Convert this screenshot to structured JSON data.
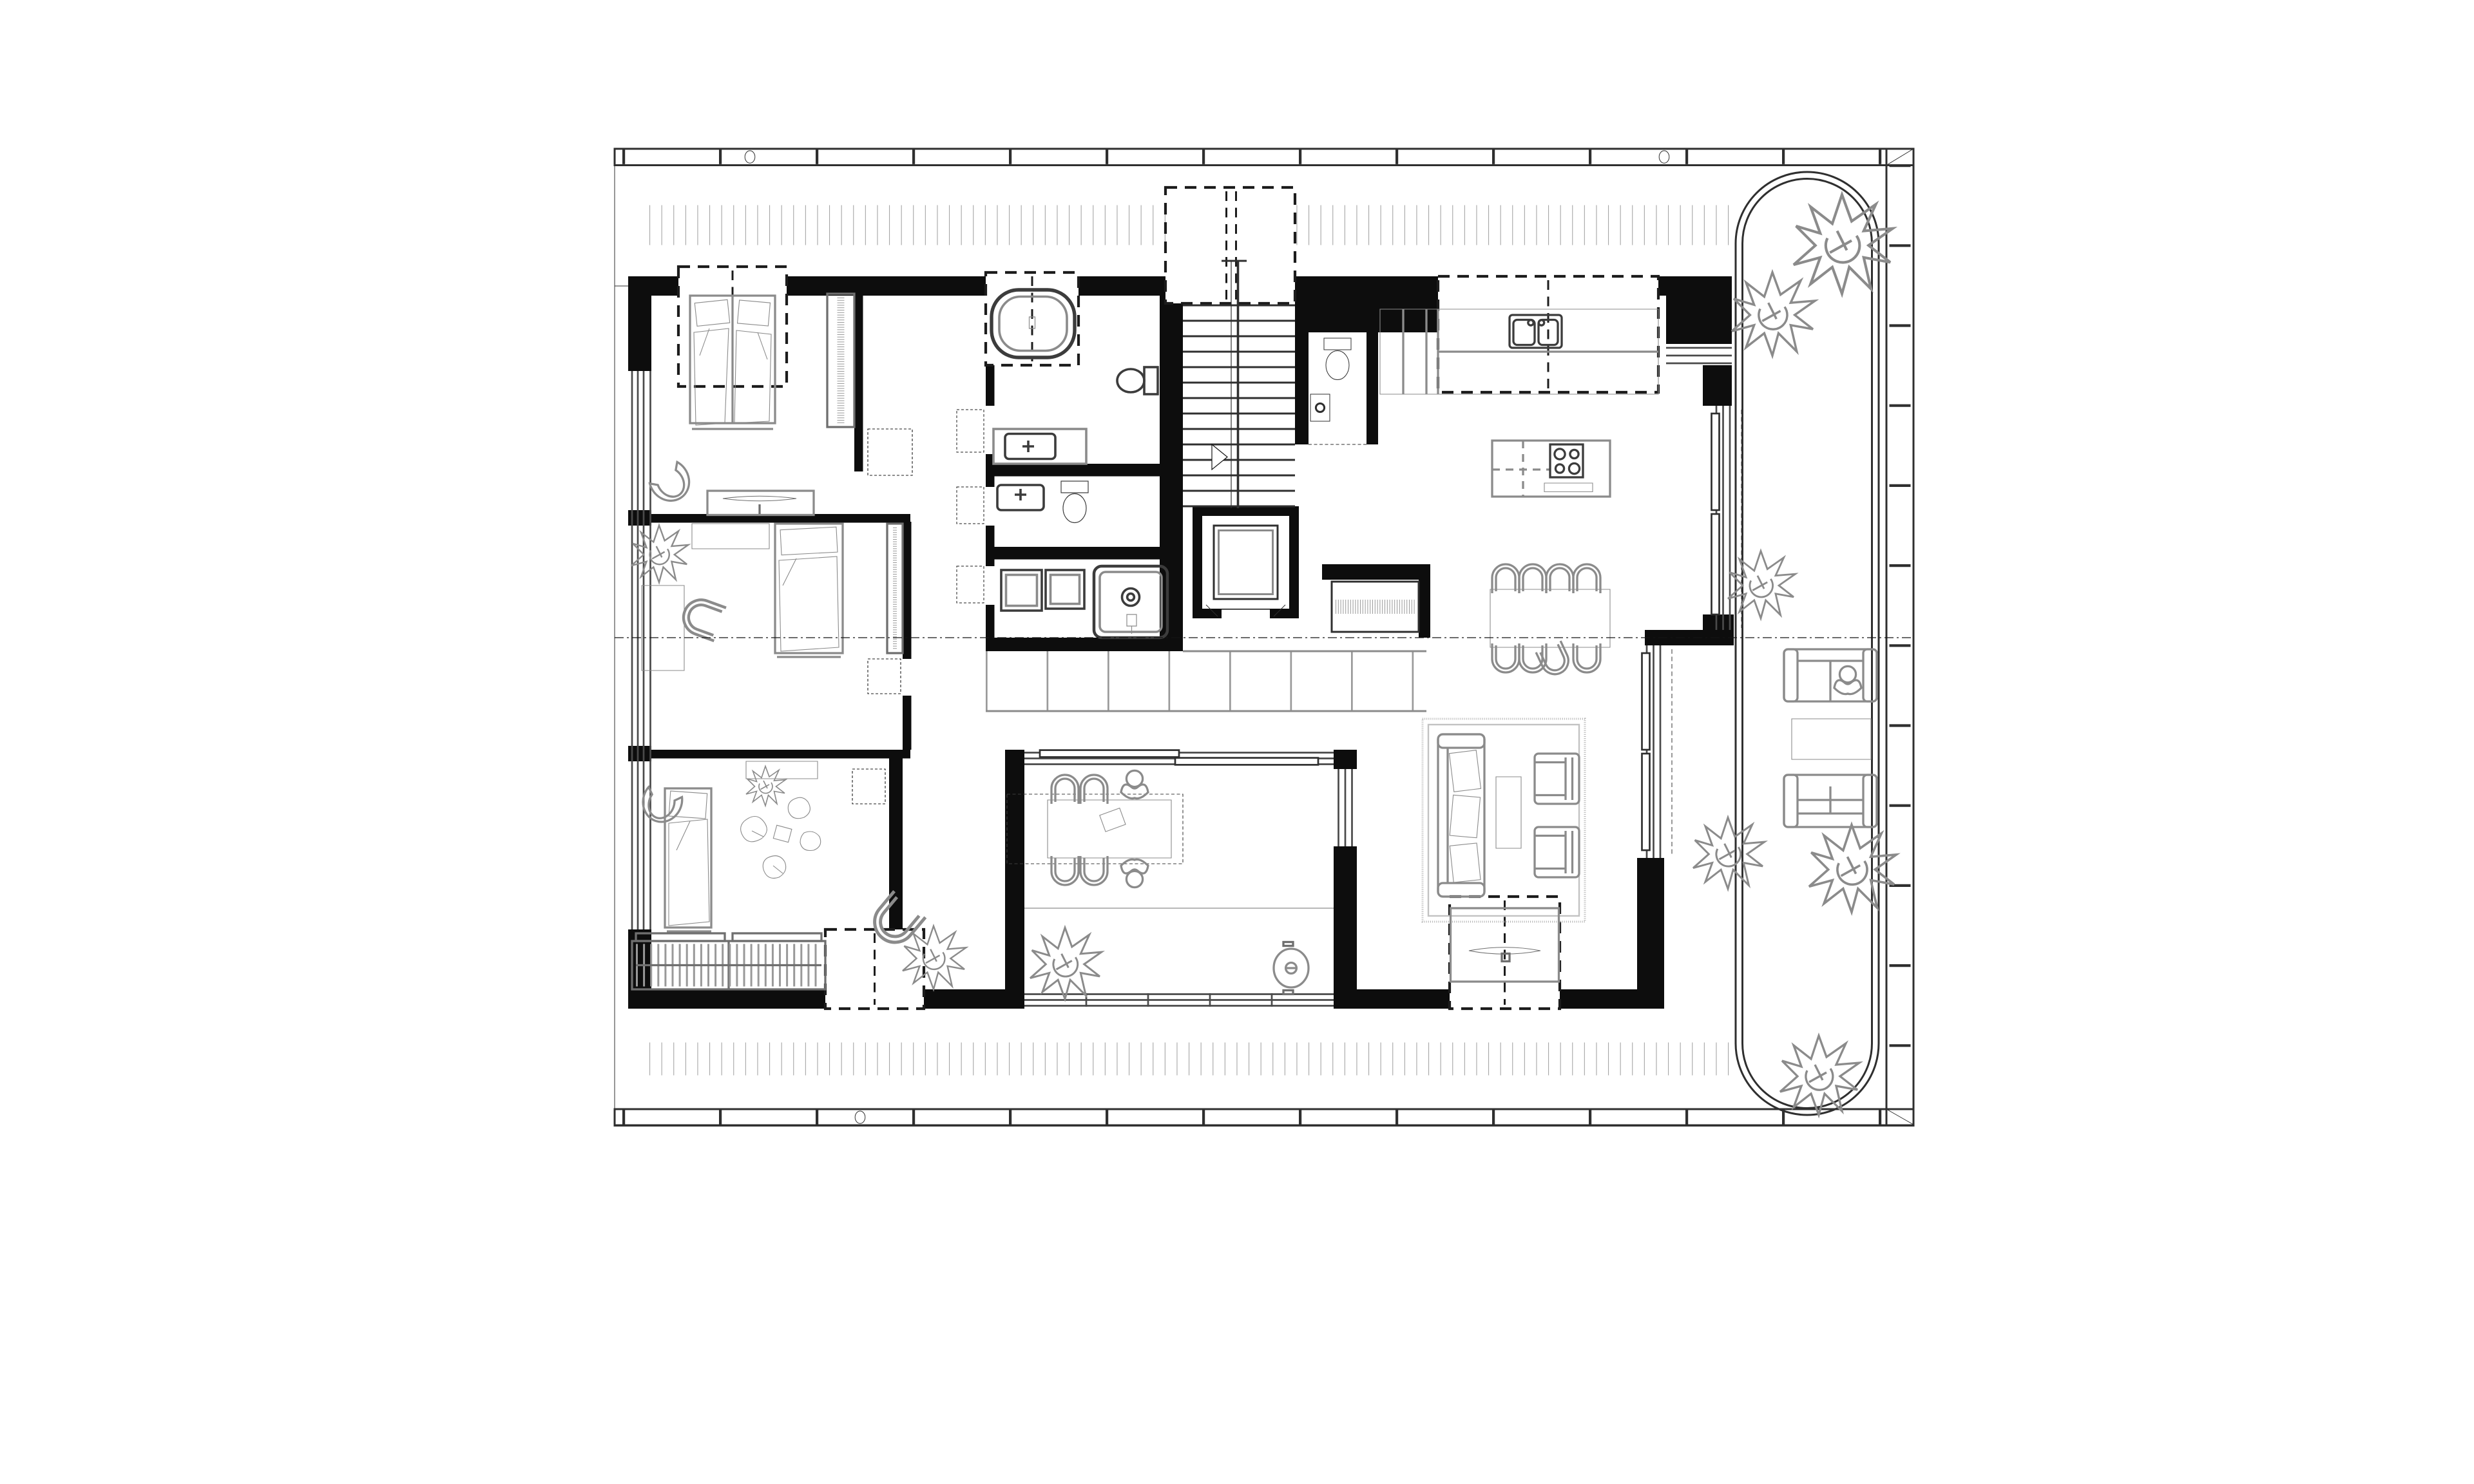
{
  "document": {
    "kind": "architectural-floor-plan",
    "view": "top-down attic apartment plan with wrap-around roof terrace",
    "visible_text": []
  },
  "colors": {
    "background": "#ffffff",
    "wall": "#0d0d0d",
    "line": "#2f2f2f",
    "furniture": "#8b8b8b",
    "fixture": "#3c3c3c",
    "deck": "#a6a6a6",
    "tile": "#9a9a9a",
    "dashed": "#1c1c1c"
  },
  "plan": {
    "outdoor": {
      "deck": [
        "top-deck-boards",
        "bottom-deck-boards",
        "right-terrace"
      ],
      "fascia": [
        "top-fascia-band",
        "right-fascia-band",
        "bottom-fascia-band",
        "fascia-circle-detail-1",
        "fascia-circle-detail-2",
        "fascia-circle-detail-3"
      ],
      "terrace_screen": "rounded-glass-screen",
      "plants": 8,
      "furniture": [
        "outdoor-sofa-with-person",
        "outdoor-coffee-table",
        "outdoor-sofa"
      ]
    },
    "rooms": [
      {
        "name": "bedroom-1",
        "items": [
          "double-bed",
          "pillows",
          "duvet",
          "roof-window-dashed",
          "wardrobe-rail",
          "desk",
          "monitor",
          "armchair",
          "door-swing-dashed"
        ]
      },
      {
        "name": "bedroom-2",
        "items": [
          "single-bed",
          "wall-shelf",
          "plant",
          "desk",
          "desk-chair",
          "wardrobe-rail",
          "door-swing-dashed"
        ]
      },
      {
        "name": "bedroom-3",
        "items": [
          "single-bed",
          "armchair",
          "wall-shelf",
          "plant",
          "children-figures",
          "toy-chair",
          "radiator",
          "roof-window-dashed",
          "door-swing-dashed"
        ]
      },
      {
        "name": "bathroom",
        "items": [
          "bathtub",
          "roof-window-dashed",
          "toilet",
          "vanity-sink"
        ]
      },
      {
        "name": "ensuite-shower-room",
        "items": [
          "vanity-sink",
          "toilet"
        ]
      },
      {
        "name": "laundry",
        "items": [
          "washer",
          "dryer",
          "shower"
        ]
      },
      {
        "name": "stairwell",
        "items": [
          "stair-treads",
          "handrail",
          "stairwell-opening-dashed"
        ]
      },
      {
        "name": "elevator",
        "items": [
          "elevator-cab",
          "door-marks"
        ]
      },
      {
        "name": "wc",
        "items": [
          "toilet",
          "corner-sink",
          "door-dashes"
        ]
      },
      {
        "name": "entry-hall",
        "items": [
          "entrance-arrow",
          "floor-tiles",
          "coat-closet-rail"
        ]
      },
      {
        "name": "kitchen",
        "items": [
          "counter",
          "double-sink",
          "upper-cabinets-dashed",
          "island",
          "cooktop",
          "extractor"
        ]
      },
      {
        "name": "dining",
        "items": [
          "dining-table",
          "eight-chairs",
          "pulled-out-chair"
        ]
      },
      {
        "name": "living-room",
        "items": [
          "fringed-rug",
          "sofa",
          "cushions",
          "coffee-table",
          "armchair",
          "armchair",
          "tv-sideboard",
          "tv",
          "roof-window-dashed"
        ]
      },
      {
        "name": "loggia",
        "items": [
          "sliding-glass-doors",
          "table",
          "four-chairs",
          "two-people",
          "plant",
          "round-basin",
          "divider"
        ]
      },
      {
        "name": "side-nook",
        "items": [
          "plant"
        ]
      }
    ],
    "annotations": [
      "section-cut-line",
      "sliding-door-dashes",
      "roof-window-boxes"
    ]
  }
}
